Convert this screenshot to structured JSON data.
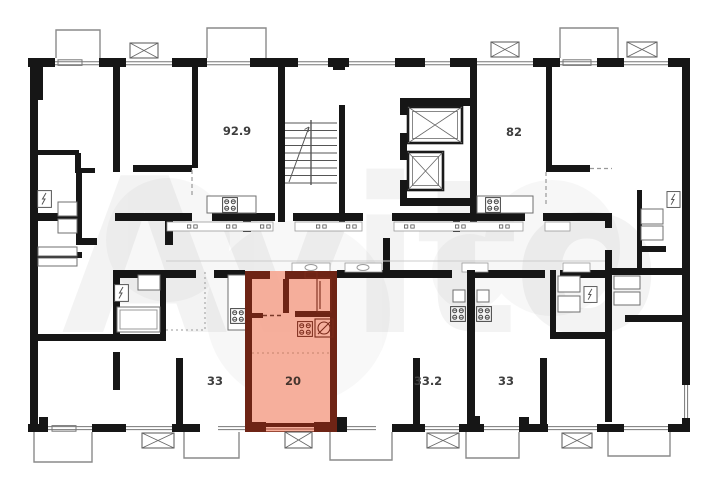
{
  "watermark": {
    "text": "Avito"
  },
  "units": [
    {
      "id": "unit-92-9",
      "area_label": "92.9"
    },
    {
      "id": "unit-82",
      "area_label": "82"
    },
    {
      "id": "unit-33-left",
      "area_label": "33"
    },
    {
      "id": "unit-20",
      "area_label": "20",
      "highlighted": true
    },
    {
      "id": "unit-33-2",
      "area_label": "33.2"
    },
    {
      "id": "unit-33-right",
      "area_label": "33"
    }
  ],
  "colors": {
    "wall": "#161616",
    "highlight_fill": "#f5a894",
    "highlight_wall": "#6e2415",
    "thin_line": "#777777",
    "balcony_line": "#8a8a8a",
    "label_text": "#3e3e3e",
    "watermark_tint": "#ebebeb"
  }
}
